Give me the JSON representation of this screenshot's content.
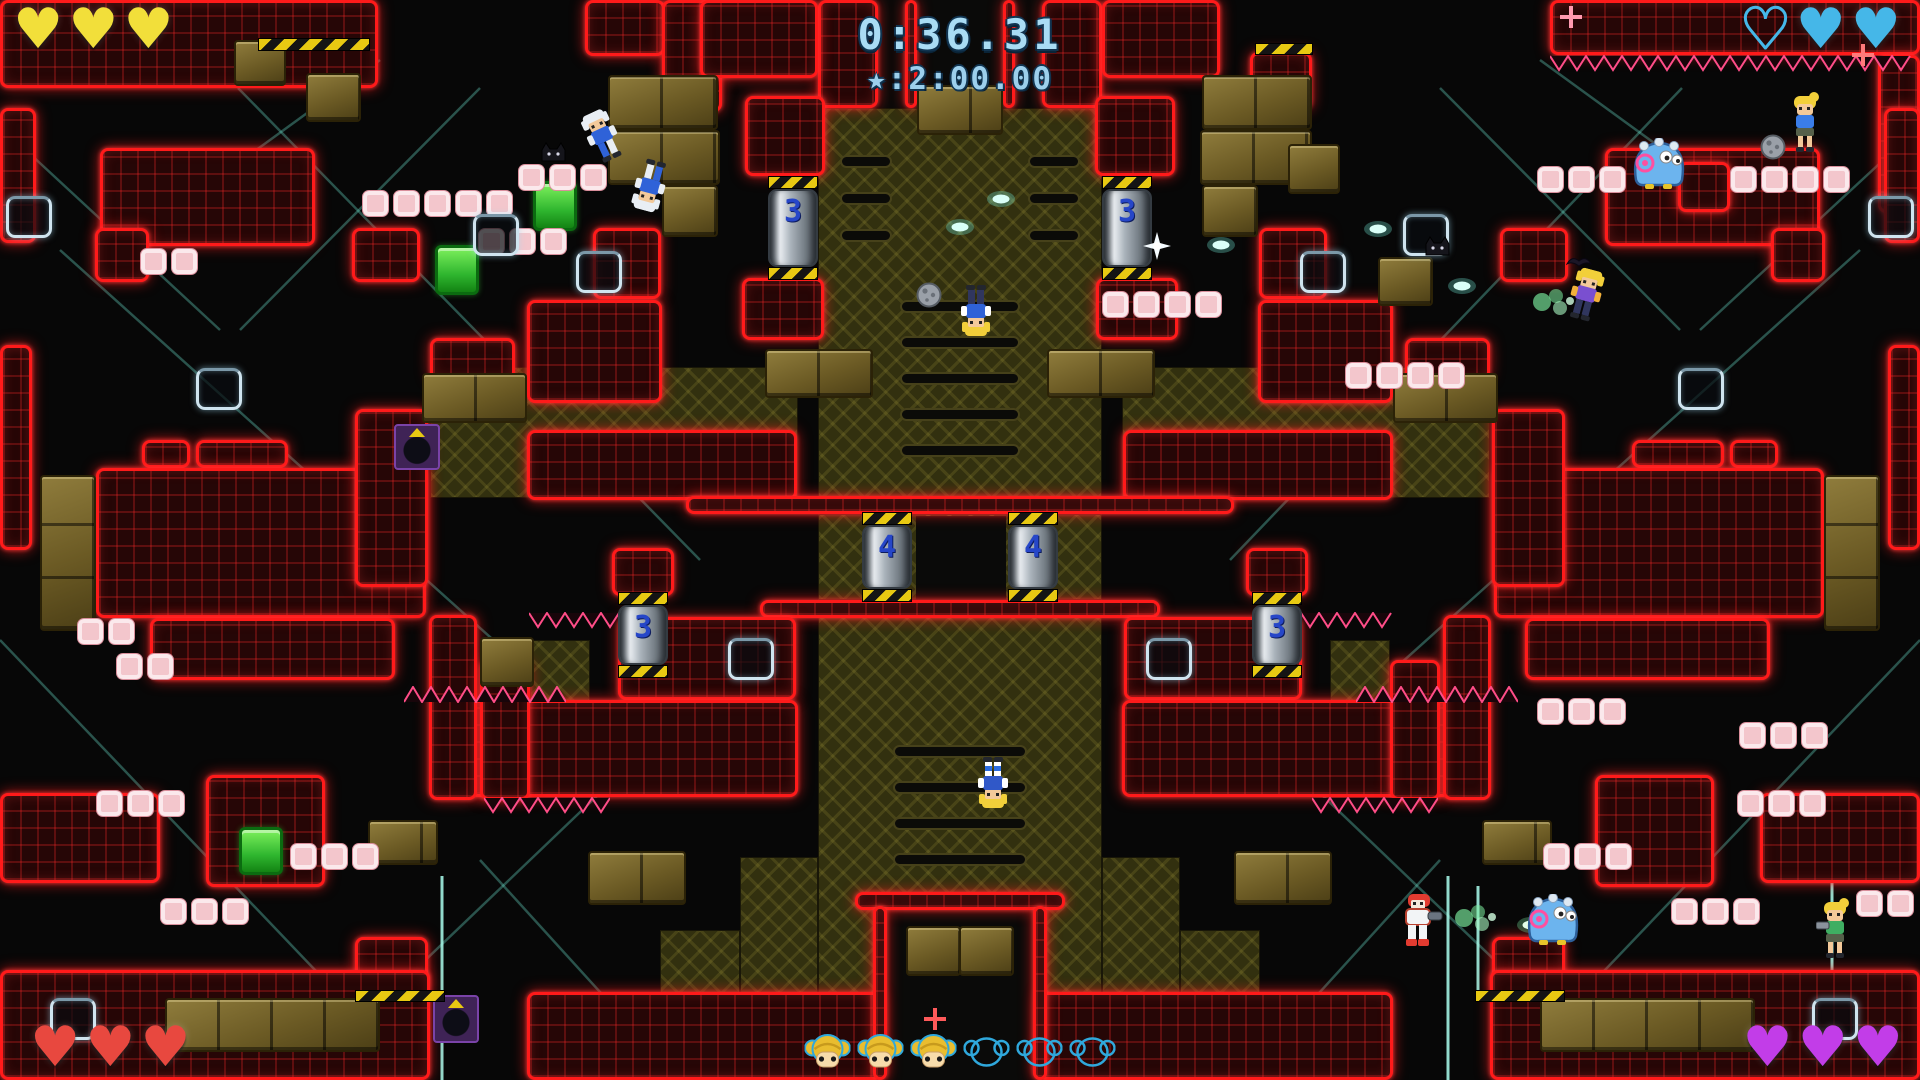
{
  "hud": {
    "timer": "0:36.31",
    "star_time": "★:2:00.00",
    "players": [
      {
        "corner": "top-left",
        "color": "#f2df3a",
        "hearts": [
          "filled",
          "filled",
          "filled"
        ]
      },
      {
        "corner": "top-right",
        "color": "#45b7e8",
        "hearts": [
          "empty",
          "filled",
          "filled"
        ]
      },
      {
        "corner": "bottom-left",
        "color": "#e8483f",
        "hearts": [
          "filled",
          "filled",
          "filled"
        ]
      },
      {
        "corner": "bottom-right",
        "color": "#c23de8",
        "hearts": [
          "filled",
          "filled",
          "filled"
        ]
      }
    ],
    "tokens": [
      "filled",
      "filled",
      "filled",
      "empty",
      "empty",
      "empty"
    ],
    "token_fill_color": "#e9bd2f",
    "token_outline_color": "#2fa8dc"
  },
  "level": {
    "accent_red": "#ff1a1a",
    "lines": [
      [
        238,
        88,
        700,
        560
      ],
      [
        60,
        250,
        560,
        700
      ],
      [
        0,
        640,
        420,
        1080
      ],
      [
        300,
        1080,
        760,
        640
      ],
      [
        480,
        88,
        240,
        330
      ],
      [
        680,
        1080,
        480,
        860
      ],
      [
        1682,
        88,
        1230,
        560
      ],
      [
        1860,
        250,
        1360,
        700
      ],
      [
        1920,
        640,
        1500,
        1080
      ],
      [
        1620,
        1080,
        1160,
        640
      ],
      [
        1440,
        88,
        1680,
        330
      ],
      [
        1240,
        1080,
        1440,
        860
      ],
      [
        1540,
        60,
        1760,
        220
      ],
      [
        1905,
        140,
        1700,
        330
      ],
      [
        380,
        60,
        160,
        220
      ],
      [
        15,
        140,
        220,
        330
      ]
    ],
    "bright_lines": [
      [
        1832,
        856,
        1832,
        1080
      ],
      [
        1448,
        876,
        1448,
        1080
      ],
      [
        1478,
        886,
        1478,
        1000
      ],
      [
        442,
        876,
        442,
        1080
      ]
    ],
    "khaki": [
      [
        818,
        108,
        284,
        390
      ],
      [
        818,
        514,
        284,
        86
      ],
      [
        818,
        600,
        284,
        400
      ],
      [
        430,
        367,
        368,
        131
      ],
      [
        1122,
        367,
        368,
        131
      ],
      [
        740,
        857,
        78,
        143
      ],
      [
        1102,
        857,
        78,
        143
      ],
      [
        660,
        930,
        80,
        70
      ],
      [
        1180,
        930,
        80,
        70
      ],
      [
        530,
        640,
        60,
        85
      ],
      [
        1330,
        640,
        60,
        85
      ]
    ],
    "black": [
      [
        878,
        0,
        164,
        108
      ],
      [
        916,
        516,
        90,
        84
      ],
      [
        887,
        906,
        146,
        174
      ]
    ],
    "slots": [
      [
        840,
        155,
        52,
        13
      ],
      [
        840,
        192,
        52,
        13
      ],
      [
        840,
        229,
        52,
        13
      ],
      [
        1028,
        155,
        52,
        13
      ],
      [
        1028,
        192,
        52,
        13
      ],
      [
        1028,
        229,
        52,
        13
      ],
      [
        900,
        300,
        120,
        13
      ],
      [
        900,
        336,
        120,
        13
      ],
      [
        900,
        372,
        120,
        13
      ],
      [
        900,
        408,
        120,
        13
      ],
      [
        900,
        444,
        120,
        13
      ],
      [
        893,
        745,
        134,
        13
      ],
      [
        893,
        781,
        134,
        13
      ],
      [
        893,
        817,
        134,
        13
      ],
      [
        893,
        853,
        134,
        13
      ]
    ],
    "red": [
      [
        0,
        0,
        378,
        88
      ],
      [
        585,
        0,
        80,
        56
      ],
      [
        662,
        0,
        60,
        112
      ],
      [
        818,
        0,
        60,
        108
      ],
      [
        1042,
        0,
        60,
        108
      ],
      [
        905,
        0,
        12,
        108
      ],
      [
        1003,
        0,
        12,
        108
      ],
      [
        700,
        0,
        118,
        78
      ],
      [
        1102,
        0,
        118,
        78
      ],
      [
        1550,
        0,
        370,
        55
      ],
      [
        1250,
        52,
        62,
        58
      ],
      [
        1878,
        55,
        42,
        158
      ],
      [
        0,
        108,
        36,
        135
      ],
      [
        1884,
        108,
        36,
        135
      ],
      [
        100,
        148,
        215,
        98
      ],
      [
        1605,
        148,
        215,
        98
      ],
      [
        95,
        228,
        54,
        54
      ],
      [
        1771,
        228,
        54,
        54
      ],
      [
        352,
        228,
        68,
        54
      ],
      [
        1500,
        228,
        68,
        54
      ],
      [
        593,
        228,
        68,
        71
      ],
      [
        1259,
        228,
        68,
        71
      ],
      [
        1678,
        162,
        52,
        50
      ],
      [
        745,
        96,
        80,
        80
      ],
      [
        1095,
        96,
        80,
        80
      ],
      [
        742,
        278,
        82,
        62
      ],
      [
        1096,
        278,
        82,
        62
      ],
      [
        0,
        345,
        32,
        205
      ],
      [
        1888,
        345,
        32,
        205
      ],
      [
        142,
        440,
        48,
        28
      ],
      [
        196,
        440,
        92,
        28
      ],
      [
        1730,
        440,
        48,
        28
      ],
      [
        1632,
        440,
        92,
        28
      ],
      [
        96,
        468,
        330,
        150
      ],
      [
        1494,
        468,
        330,
        150
      ],
      [
        150,
        618,
        245,
        62
      ],
      [
        1525,
        618,
        245,
        62
      ],
      [
        355,
        409,
        73,
        178
      ],
      [
        1492,
        409,
        73,
        178
      ],
      [
        430,
        338,
        85,
        42
      ],
      [
        1405,
        338,
        85,
        42
      ],
      [
        527,
        300,
        135,
        103
      ],
      [
        1258,
        300,
        135,
        103
      ],
      [
        527,
        430,
        270,
        70
      ],
      [
        1123,
        430,
        270,
        70
      ],
      [
        686,
        496,
        548,
        18
      ],
      [
        760,
        600,
        400,
        18
      ],
      [
        612,
        548,
        62,
        48
      ],
      [
        1246,
        548,
        62,
        48
      ],
      [
        618,
        617,
        178,
        83
      ],
      [
        1124,
        617,
        178,
        83
      ],
      [
        470,
        700,
        328,
        97
      ],
      [
        1122,
        700,
        328,
        97
      ],
      [
        429,
        615,
        48,
        185
      ],
      [
        1443,
        615,
        48,
        185
      ],
      [
        480,
        660,
        50,
        140
      ],
      [
        1390,
        660,
        50,
        140
      ],
      [
        206,
        775,
        119,
        112
      ],
      [
        1595,
        775,
        119,
        112
      ],
      [
        0,
        793,
        160,
        90
      ],
      [
        1760,
        793,
        160,
        90
      ],
      [
        355,
        937,
        73,
        55
      ],
      [
        1492,
        937,
        73,
        55
      ],
      [
        0,
        970,
        430,
        110
      ],
      [
        1490,
        970,
        430,
        110
      ],
      [
        527,
        992,
        355,
        88
      ],
      [
        1038,
        992,
        355,
        88
      ],
      [
        855,
        892,
        210,
        18
      ],
      [
        873,
        906,
        14,
        174
      ],
      [
        1033,
        906,
        14,
        174
      ]
    ],
    "gold": [
      [
        40,
        475,
        56,
        156
      ],
      [
        1824,
        475,
        56,
        156
      ],
      [
        234,
        40,
        52,
        46
      ],
      [
        306,
        73,
        55,
        49
      ],
      [
        608,
        75,
        110,
        55
      ],
      [
        608,
        130,
        112,
        55
      ],
      [
        662,
        185,
        56,
        52
      ],
      [
        1202,
        75,
        110,
        55
      ],
      [
        1200,
        130,
        112,
        55
      ],
      [
        1202,
        185,
        56,
        52
      ],
      [
        917,
        85,
        86,
        50
      ],
      [
        422,
        373,
        105,
        50
      ],
      [
        1393,
        373,
        105,
        50
      ],
      [
        765,
        349,
        108,
        49
      ],
      [
        1047,
        349,
        108,
        49
      ],
      [
        1288,
        144,
        52,
        50
      ],
      [
        1378,
        257,
        55,
        49
      ],
      [
        480,
        637,
        54,
        50
      ],
      [
        165,
        998,
        215,
        54
      ],
      [
        1540,
        998,
        215,
        54
      ],
      [
        588,
        851,
        98,
        54
      ],
      [
        1234,
        851,
        98,
        54
      ],
      [
        368,
        820,
        70,
        45
      ],
      [
        1482,
        820,
        70,
        45
      ],
      [
        906,
        926,
        55,
        50
      ],
      [
        959,
        926,
        55,
        50
      ]
    ],
    "green": [
      [
        533,
        181,
        44,
        50
      ],
      [
        435,
        245,
        44,
        50
      ],
      [
        239,
        827,
        44,
        48
      ]
    ],
    "purple": [
      [
        394,
        424,
        46,
        46
      ],
      [
        433,
        995,
        46,
        48
      ]
    ],
    "pink_rows": [
      [
        518,
        164,
        3
      ],
      [
        362,
        190,
        5
      ],
      [
        140,
        248,
        2
      ],
      [
        478,
        228,
        3
      ],
      [
        1102,
        291,
        4
      ],
      [
        1345,
        362,
        4
      ],
      [
        1537,
        166,
        3
      ],
      [
        1730,
        166,
        4
      ],
      [
        77,
        618,
        2
      ],
      [
        116,
        653,
        2
      ],
      [
        96,
        790,
        3
      ],
      [
        290,
        843,
        3
      ],
      [
        160,
        898,
        3
      ],
      [
        1737,
        790,
        3
      ],
      [
        1543,
        843,
        3
      ],
      [
        1671,
        898,
        3
      ],
      [
        1537,
        698,
        3
      ],
      [
        1739,
        722,
        3
      ],
      [
        1856,
        890,
        2
      ]
    ],
    "hazards": [
      [
        258,
        38,
        112,
        13
      ],
      [
        1255,
        43,
        58,
        12
      ],
      [
        355,
        990,
        90,
        12
      ],
      [
        1475,
        990,
        90,
        12
      ]
    ],
    "spikes": [
      {
        "x": 1550,
        "y": 55,
        "w": 370,
        "dir": "down"
      },
      {
        "x": 404,
        "y": 686,
        "w": 162,
        "dir": "up"
      },
      {
        "x": 1356,
        "y": 686,
        "w": 162,
        "dir": "up"
      },
      {
        "x": 484,
        "y": 797,
        "w": 126,
        "dir": "down"
      },
      {
        "x": 1312,
        "y": 797,
        "w": 126,
        "dir": "down"
      },
      {
        "x": 529,
        "y": 612,
        "w": 110,
        "dir": "down"
      },
      {
        "x": 1283,
        "y": 612,
        "w": 110,
        "dir": "down"
      }
    ],
    "doors": [
      [
        6,
        196
      ],
      [
        1868,
        196
      ],
      [
        473,
        214
      ],
      [
        1403,
        214
      ],
      [
        576,
        251
      ],
      [
        1300,
        251
      ],
      [
        196,
        368
      ],
      [
        1678,
        368
      ],
      [
        728,
        638
      ],
      [
        1146,
        638
      ],
      [
        50,
        998
      ],
      [
        1812,
        998
      ]
    ],
    "pistons": [
      {
        "x": 768,
        "y": 176,
        "h": 104,
        "label": "3"
      },
      {
        "x": 1102,
        "y": 176,
        "h": 104,
        "label": "3"
      },
      {
        "x": 862,
        "y": 512,
        "h": 90,
        "label": "4"
      },
      {
        "x": 1008,
        "y": 512,
        "h": 90,
        "label": "4"
      },
      {
        "x": 618,
        "y": 592,
        "h": 86,
        "label": "3"
      },
      {
        "x": 1252,
        "y": 592,
        "h": 86,
        "label": "3"
      }
    ],
    "sprites": [
      {
        "t": "hero",
        "x": 588,
        "y": 104,
        "rot": -25,
        "v": "cop"
      },
      {
        "t": "hero",
        "x": 610,
        "y": 138,
        "rot": 195,
        "v": "cop"
      },
      {
        "t": "hero",
        "x": 933,
        "y": 266,
        "rot": 180,
        "v": "cop2"
      },
      {
        "t": "ball",
        "x": 916,
        "y": 282
      },
      {
        "t": "hero",
        "x": 950,
        "y": 738,
        "rot": 180,
        "v": "stripe"
      },
      {
        "t": "armor",
        "x": 1400,
        "y": 894
      },
      {
        "t": "shotg",
        "x": 1452,
        "y": 900
      },
      {
        "t": "bulletg",
        "x": 1516,
        "y": 916
      },
      {
        "t": "blob",
        "x": 1630,
        "y": 138
      },
      {
        "t": "blob",
        "x": 1524,
        "y": 894
      },
      {
        "t": "girl",
        "x": 1786,
        "y": 92,
        "v": "plain"
      },
      {
        "t": "ball",
        "x": 1760,
        "y": 134
      },
      {
        "t": "girl",
        "x": 1816,
        "y": 898,
        "v": "gun"
      },
      {
        "t": "hero",
        "x": 1566,
        "y": 272,
        "rot": 15,
        "v": "jump"
      },
      {
        "t": "shotg",
        "x": 1530,
        "y": 284
      },
      {
        "t": "bat",
        "x": 1566,
        "y": 254
      },
      {
        "t": "cat",
        "x": 538,
        "y": 140
      },
      {
        "t": "cat",
        "x": 1422,
        "y": 234
      },
      {
        "t": "bullet",
        "x": 986,
        "y": 190
      },
      {
        "t": "bullet",
        "x": 1206,
        "y": 236
      },
      {
        "t": "bullet",
        "x": 1363,
        "y": 220
      },
      {
        "t": "bullet",
        "x": 1447,
        "y": 277
      },
      {
        "t": "bullet",
        "x": 945,
        "y": 218
      },
      {
        "t": "flash",
        "x": 1143,
        "y": 232
      },
      {
        "t": "sparkle",
        "x": 924,
        "y": 1008,
        "c": "#ff5a5a"
      },
      {
        "t": "sparkle",
        "x": 1852,
        "y": 44,
        "c": "#ff7a7a"
      },
      {
        "t": "sparkle",
        "x": 1560,
        "y": 6,
        "c": "#ff9ab0"
      }
    ]
  }
}
